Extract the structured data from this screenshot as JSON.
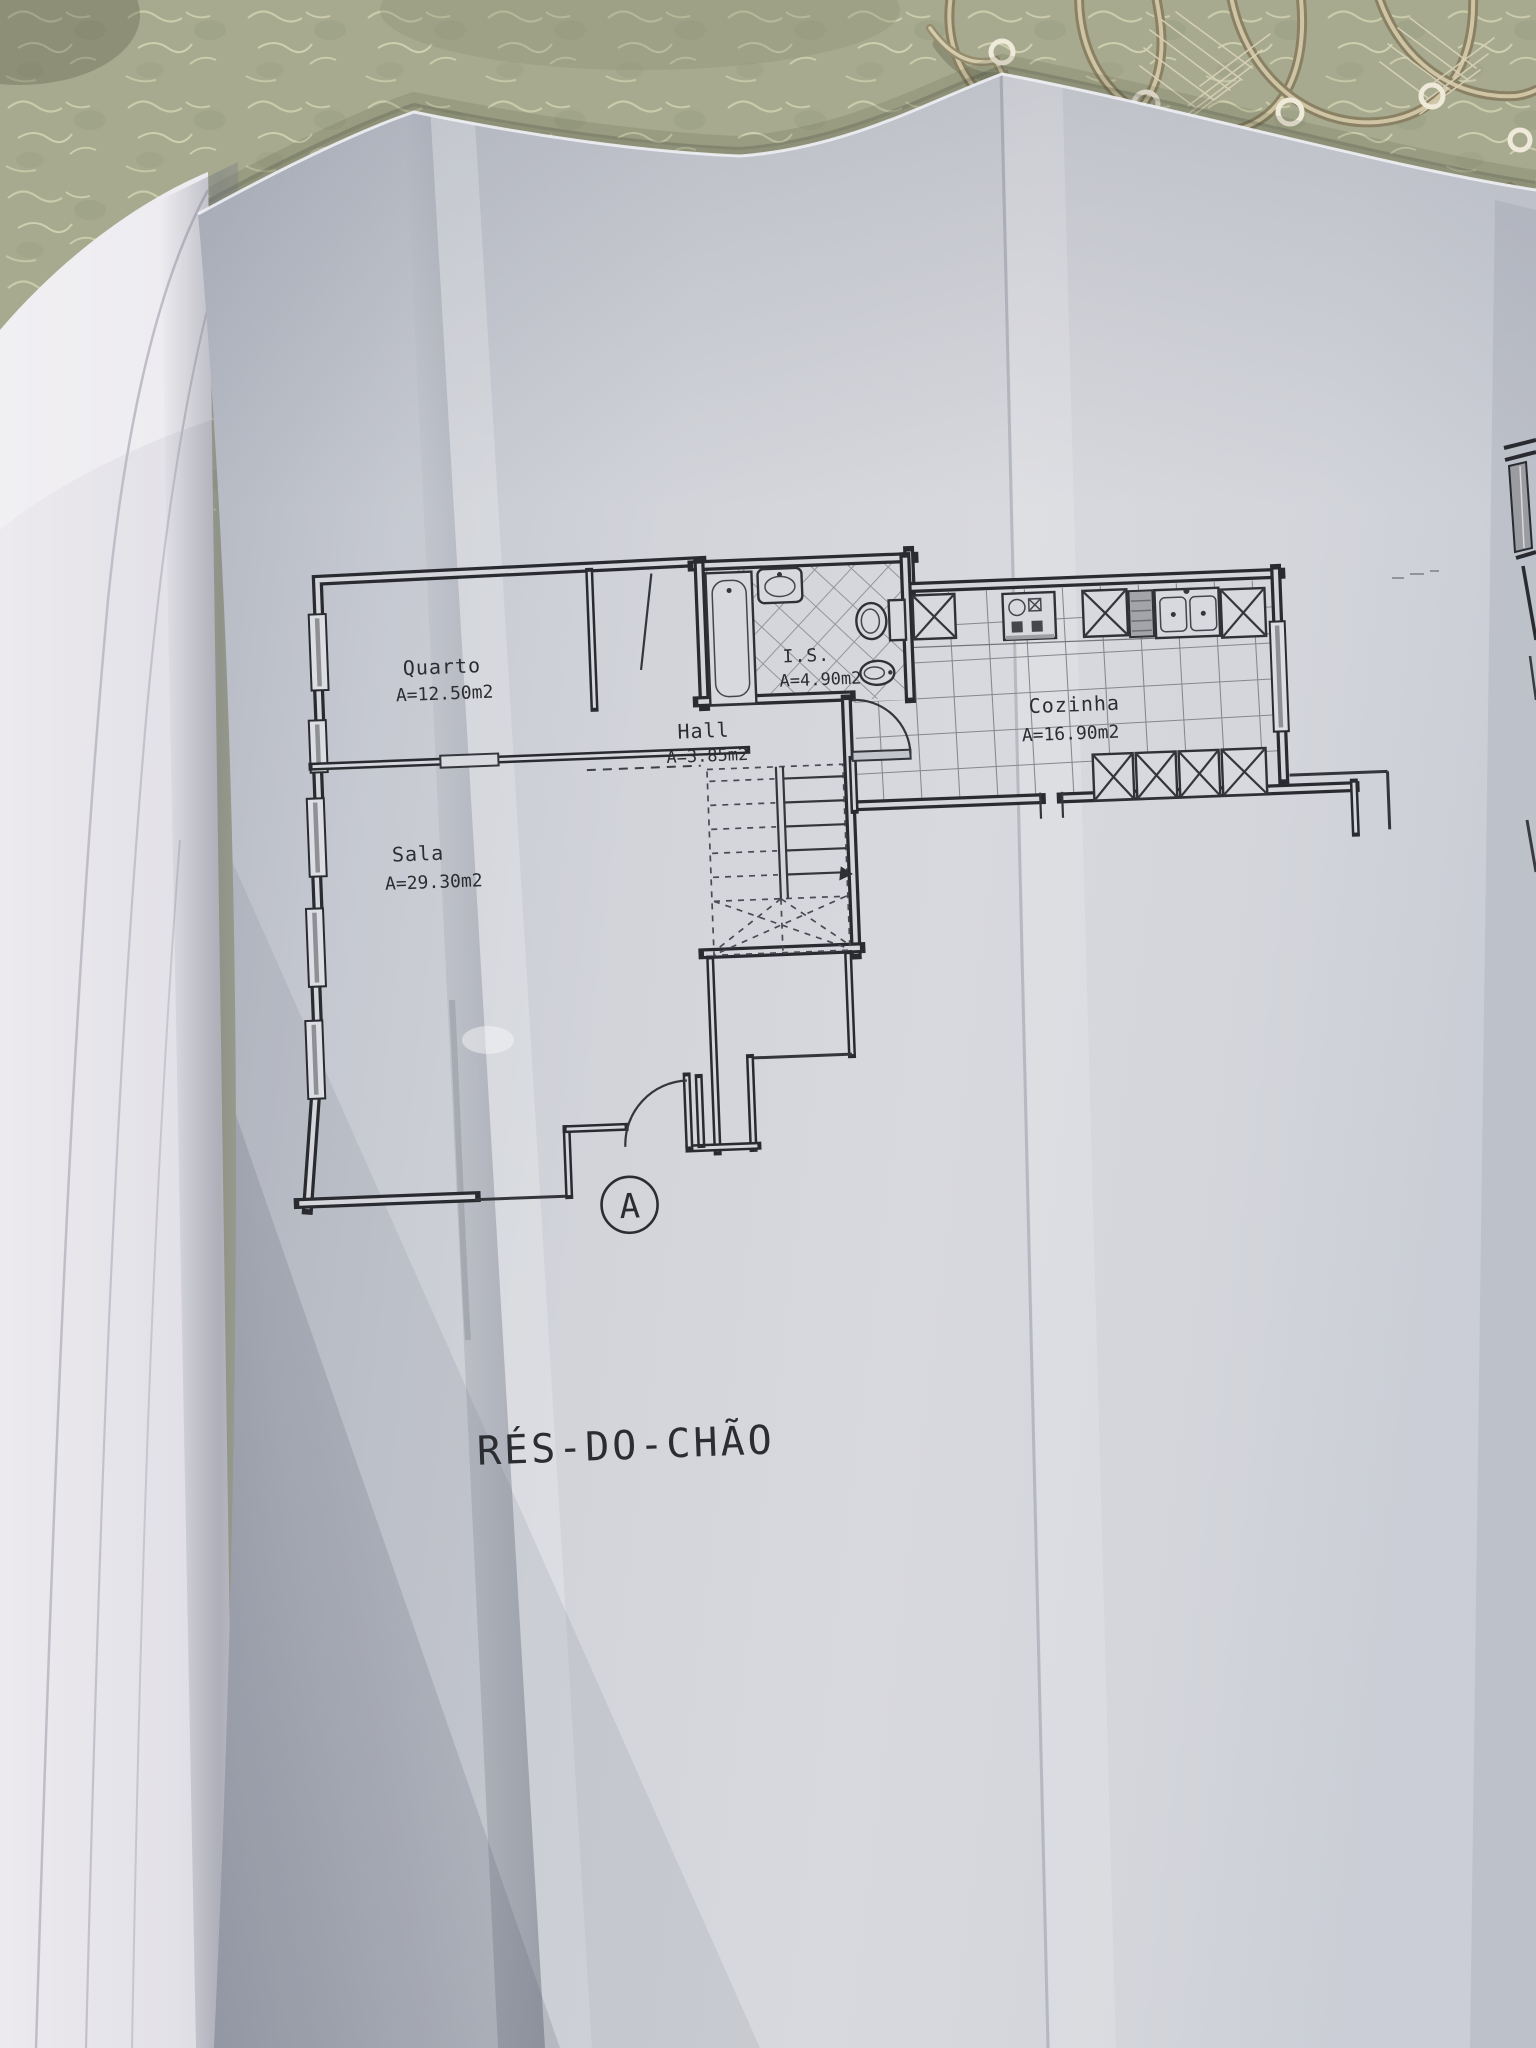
{
  "plan": {
    "title": "RÉS-DO-CHÃO",
    "entrance_marker": "A",
    "rooms": [
      {
        "name": "Quarto",
        "area": "A=12.50m2"
      },
      {
        "name": "Sala",
        "area": "A=29.30m2"
      },
      {
        "name": "Hall",
        "area": "A=3.85m2"
      },
      {
        "name": "I.S.",
        "area": "A=4.90m2"
      },
      {
        "name": "Cozinha",
        "area": "A=16.90m2"
      }
    ]
  },
  "colors": {
    "tablecloth": "#a7aa8e",
    "doily_cord": "#8a8165",
    "paper": "#d2d4da",
    "side_pages": "#eceaee",
    "ink": "#2a2b30"
  }
}
